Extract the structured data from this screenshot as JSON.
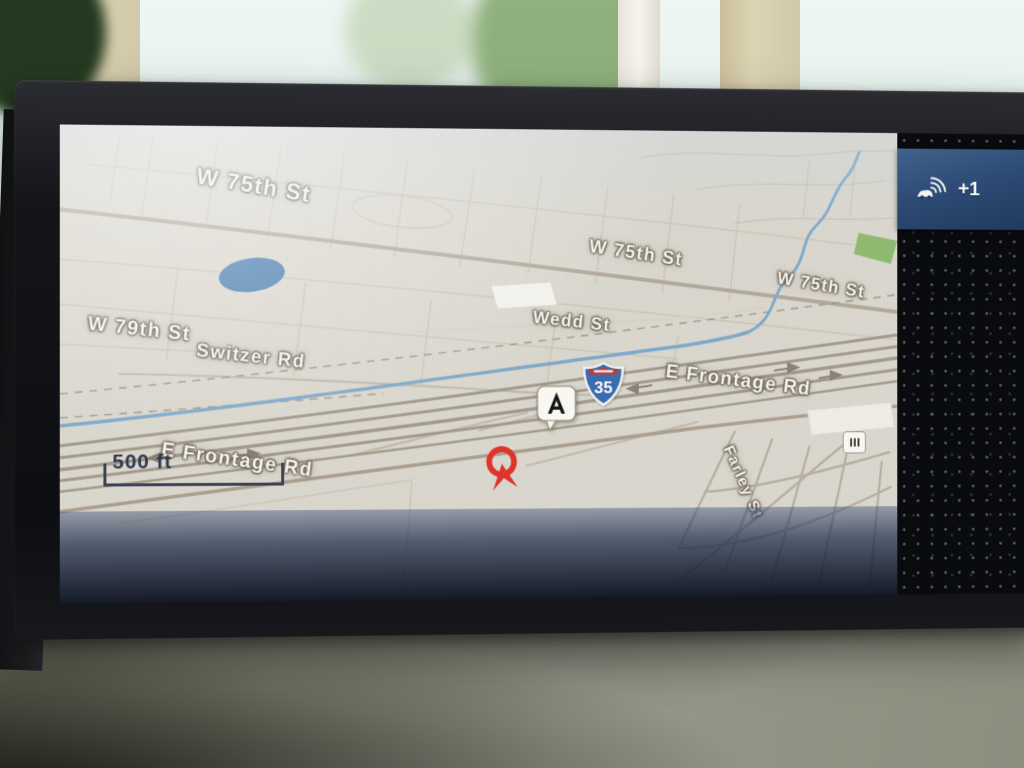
{
  "status_bar": {
    "connectivity_count": "+1",
    "icon": "car-wifi-icon"
  },
  "map": {
    "scale_label": "500 ft",
    "interstate_shield": {
      "number": "35"
    },
    "road_labels": [
      {
        "id": "w75-1",
        "text": "W 75th St"
      },
      {
        "id": "w75-2",
        "text": "W 75th St"
      },
      {
        "id": "w75-3",
        "text": "W 75th St"
      },
      {
        "id": "wedd",
        "text": "Wedd St"
      },
      {
        "id": "w79",
        "text": "W 79th St"
      },
      {
        "id": "switzer",
        "text": "Switzer Rd"
      },
      {
        "id": "efrontage-east",
        "text": "E Frontage Rd"
      },
      {
        "id": "efrontage-west",
        "text": "E Frontage Rd"
      },
      {
        "id": "farley",
        "text": "Farley St"
      },
      {
        "id": "st-partial",
        "text": "St"
      }
    ],
    "markers": [
      {
        "id": "dealer-pin",
        "icon": "acura-logo-pin"
      },
      {
        "id": "vehicle",
        "icon": "vehicle-position-arrow"
      },
      {
        "id": "poi",
        "icon": "poi-icon"
      }
    ],
    "colors": {
      "background": "#dad7ce",
      "water": "#7fa9cb",
      "park": "#90ba70",
      "road_major": "#b3a99a",
      "label_text": "#f7f4ec",
      "vehicle_marker": "#e0342a",
      "shield_blue": "#3a6cb0",
      "shield_red": "#c23b31",
      "bottom_band": "#1e2d4c",
      "status_bar": "#2d4b74"
    }
  }
}
